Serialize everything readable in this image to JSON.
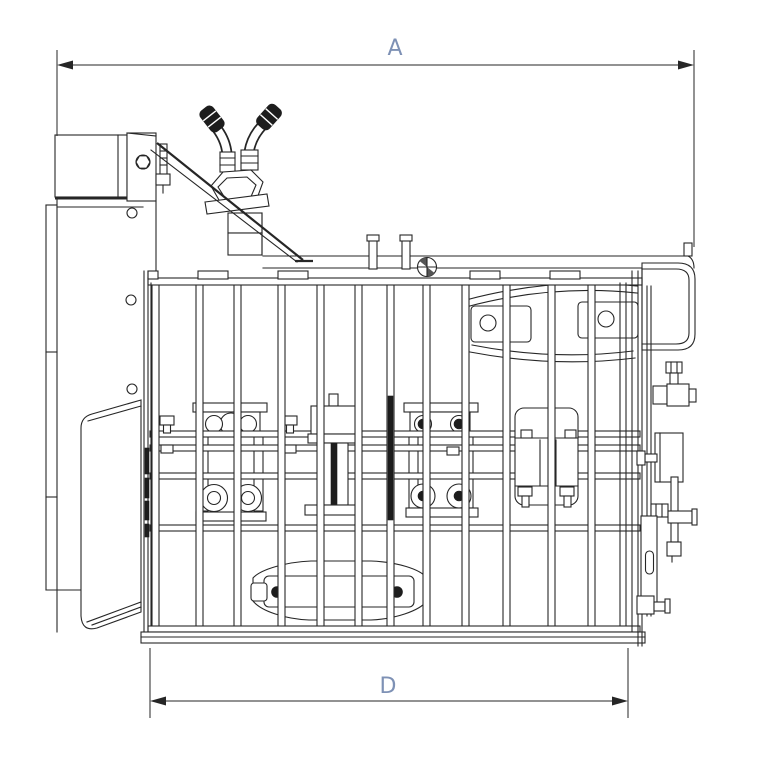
{
  "drawing": {
    "dim_a_label": "A",
    "dim_d_label": "D",
    "colors": {
      "background": "#ffffff",
      "line": "#262626",
      "dark": "#1d1d1d",
      "dim_text": "#7e91b5"
    }
  }
}
